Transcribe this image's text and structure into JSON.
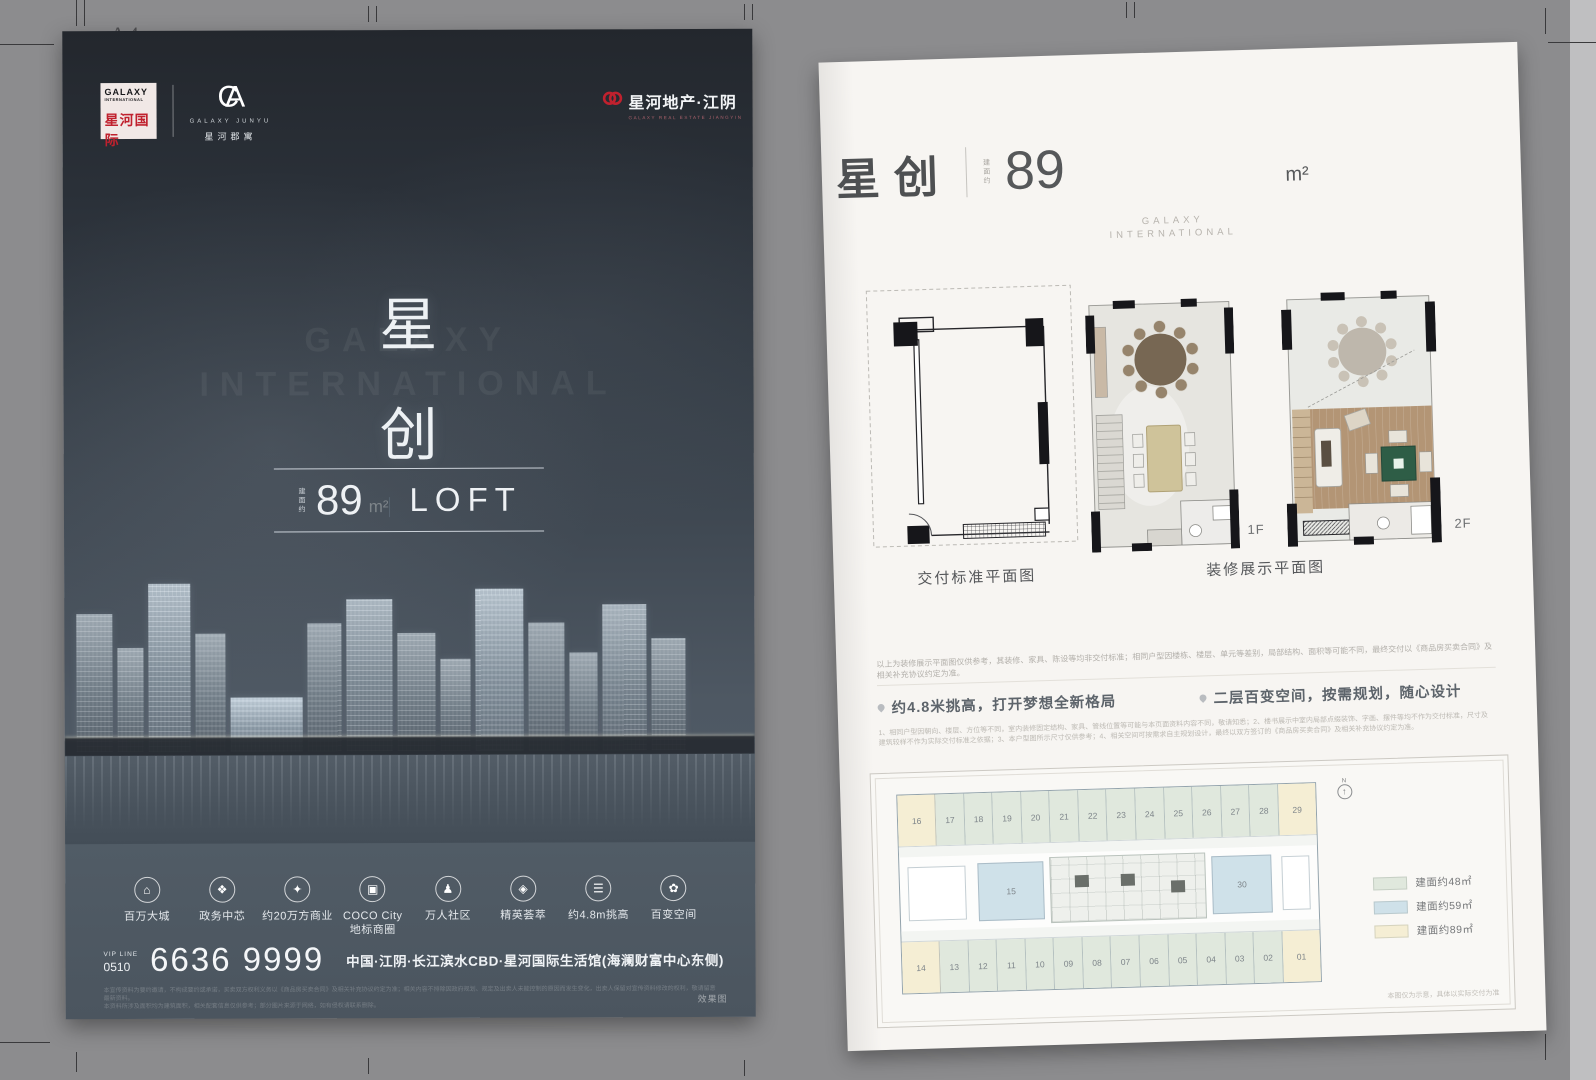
{
  "photo": {
    "sheet_label": "A4"
  },
  "poster": {
    "logo_box": {
      "en1": "GALAXY",
      "en2": "INTERNATIONAL",
      "cn": "星河国际"
    },
    "junyu": {
      "monogram_c": "C",
      "monogram_a": "A",
      "en": "GALAXY JUNYU",
      "cn": "星河郡寓"
    },
    "dev_logo": {
      "cn": "星河地产·江阴",
      "en": "GALAXY REAL ESTATE JIANGYIN"
    },
    "watermark": "GALAXY\nINTERNATIONAL",
    "title_char1": "星",
    "title_char2": "创",
    "badge": {
      "prefix": "建面约",
      "number": "89",
      "unit": "m²",
      "suffix": "LOFT"
    },
    "amenities": [
      {
        "icon": "city-icon",
        "glyph": "⌂",
        "label": "百万大城"
      },
      {
        "icon": "government-icon",
        "glyph": "❖",
        "label": "政务中芯"
      },
      {
        "icon": "shopping-icon",
        "glyph": "✦",
        "label": "约20万方商业"
      },
      {
        "icon": "landmark-icon",
        "glyph": "▣",
        "label": "COCO City\n地标商圈"
      },
      {
        "icon": "community-icon",
        "glyph": "♟",
        "label": "万人社区"
      },
      {
        "icon": "elite-icon",
        "glyph": "◈",
        "label": "精英荟萃"
      },
      {
        "icon": "ceiling-height-icon",
        "glyph": "☰",
        "label": "约4.8m挑高"
      },
      {
        "icon": "flexible-space-icon",
        "glyph": "✿",
        "label": "百变空间"
      }
    ],
    "hotline": {
      "label": "VIP LINE",
      "area_code": "0510",
      "number": "6636 9999"
    },
    "address": "中国·江阴·长江滨水CBD·星河国际生活馆(海澜财富中心东侧)",
    "disclaimer": [
      "本宣传资料为要约邀请，不构成要约或承诺，买卖双方权利义务以《商品房买卖合同》及相关补充协议约定为准；相关内容不排除因政府规划、规定及出卖人未能控制的原因而发生变化，出卖人保留对宣传资料修改的权利，敬请留意最新资料。",
      "本资料所涉及面积均为建筑面积，相关配套信息仅供参考；部分图片来源于网络，如有侵权请联系删除。"
    ],
    "render_tag": "效果图"
  },
  "sheet": {
    "title": {
      "cn": "星创",
      "area_prefix": "建面约",
      "number": "89",
      "unit": "m²"
    },
    "brand": "GALAXY\nINTERNATIONAL",
    "plans": {
      "delivery_caption": "交付标准平面图",
      "decorated_caption": "装修展示平面图",
      "f1": "1F",
      "f2": "2F"
    },
    "note_top": "以上为装修展示平面图仅供参考，其装修、家具、陈设等均非交付标准；相同户型因楼栋、楼层、单元等差别，局部结构、面积等可能不同，最终交付以《商品房买卖合同》及相关补充协议约定为准。",
    "features": [
      "约4.8米挑高，打开梦想全新格局",
      "二层百变空间，按需规划，随心设计"
    ],
    "fine_print": [
      "1、相同户型因朝向、楼层、方位等不同，室内装修固定结构、家具、管线位置等可能与本页面资料内容不同，敬请知悉；2、楼书展示中室内局部点缀装饰、字画、摆件等均不作为交付标准，尺寸及",
      "建筑较样不作为实际交付标准之依据；3、本户型图所示尺寸仅供参考；4、相关空间可按需求自主规划设计，最终以双方签订的《商品房买卖合同》及相关补充协议约定为准。"
    ],
    "plate": {
      "north_label": "N",
      "north_glyph": "↑",
      "top_row": [
        {
          "no": "16",
          "type": "89"
        },
        {
          "no": "17",
          "type": "48"
        },
        {
          "no": "18",
          "type": "48"
        },
        {
          "no": "19",
          "type": "48"
        },
        {
          "no": "20",
          "type": "48"
        },
        {
          "no": "21",
          "type": "48"
        },
        {
          "no": "22",
          "type": "48"
        },
        {
          "no": "23",
          "type": "48"
        },
        {
          "no": "24",
          "type": "48"
        },
        {
          "no": "25",
          "type": "48"
        },
        {
          "no": "26",
          "type": "48"
        },
        {
          "no": "27",
          "type": "48"
        },
        {
          "no": "28",
          "type": "48"
        },
        {
          "no": "29",
          "type": "89"
        }
      ],
      "mid": [
        {
          "no": "15",
          "type": "59"
        },
        {
          "no": "30",
          "type": "59"
        }
      ],
      "bottom_row": [
        {
          "no": "14",
          "type": "89"
        },
        {
          "no": "13",
          "type": "48"
        },
        {
          "no": "12",
          "type": "48"
        },
        {
          "no": "11",
          "type": "48"
        },
        {
          "no": "10",
          "type": "48"
        },
        {
          "no": "09",
          "type": "48"
        },
        {
          "no": "08",
          "type": "48"
        },
        {
          "no": "07",
          "type": "48"
        },
        {
          "no": "06",
          "type": "48"
        },
        {
          "no": "05",
          "type": "48"
        },
        {
          "no": "04",
          "type": "48"
        },
        {
          "no": "03",
          "type": "48"
        },
        {
          "no": "02",
          "type": "48"
        },
        {
          "no": "01",
          "type": "89"
        }
      ],
      "legend": [
        {
          "type": "48",
          "label": "建面约48㎡"
        },
        {
          "type": "59",
          "label": "建面约59㎡"
        },
        {
          "type": "89",
          "label": "建面约89㎡"
        }
      ],
      "note": "本图仅为示意，具体以实际交付为准"
    }
  }
}
